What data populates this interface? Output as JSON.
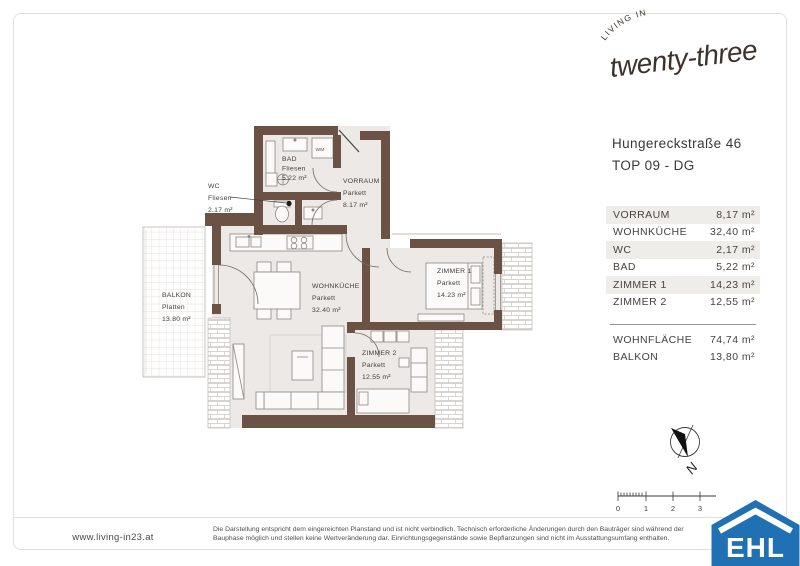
{
  "brand": {
    "arc_text": "LIVING IN",
    "script_text": "twenty-three"
  },
  "address": {
    "street": "Hungereckstraße 46",
    "unit": "TOP 09 - DG"
  },
  "area_table": {
    "rows": [
      {
        "label": "VORRAUM",
        "value": "8,17 m²"
      },
      {
        "label": "WOHNKÜCHE",
        "value": "32,40 m²"
      },
      {
        "label": "WC",
        "value": "2,17 m²"
      },
      {
        "label": "BAD",
        "value": "5,22 m²"
      },
      {
        "label": "ZIMMER 1",
        "value": "14,23 m²"
      },
      {
        "label": "ZIMMER 2",
        "value": "12,55 m²"
      }
    ],
    "totals": [
      {
        "label": "WOHNFLÄCHE",
        "value": "74,74 m²"
      },
      {
        "label": "BALKON",
        "value": "13,80 m²"
      }
    ]
  },
  "plan": {
    "rooms": {
      "bad": {
        "name": "BAD",
        "floor": "Fliesen",
        "area": "5.22 m²"
      },
      "wc": {
        "name": "WC",
        "floor": "Fliesen",
        "area": "2.17 m²"
      },
      "vorraum": {
        "name": "VORRAUM",
        "floor": "Parkett",
        "area": "8.17 m²"
      },
      "wohnkueche": {
        "name": "WOHNKÜCHE",
        "floor": "Parkett",
        "area": "32.40 m²"
      },
      "zimmer1": {
        "name": "ZIMMER 1",
        "floor": "Parkett",
        "area": "14.23 m²"
      },
      "zimmer2": {
        "name": "ZIMMER 2",
        "floor": "Parkett",
        "area": "12.55 m²"
      },
      "balkon": {
        "name": "BALKON",
        "floor": "Platten",
        "area": "13.80 m²"
      }
    },
    "wm_label": "WM",
    "compass_label": "N",
    "scale_labels": [
      "0",
      "1",
      "2",
      "3"
    ]
  },
  "footer": {
    "website": "www.living-in23.at",
    "disclaimer_line1": "Die Darstellung entspricht dem eingereichten Planstand und ist nicht verbindlich. Technisch erforderliche Änderungen durch den Bauträger sind während der",
    "disclaimer_line2": "Bauphase möglich und stellen keine Wertveränderung dar. Einrichtungsgegenstände sowie Bepflanzungen sind nicht im Ausstattungsumfang enthalten.",
    "ehl": "EHL"
  },
  "colors": {
    "wall_brown": "#6C5244",
    "room_fill": "#ECE9E6",
    "ehl_blue": "#2070B4",
    "text_dark": "#44403b"
  }
}
